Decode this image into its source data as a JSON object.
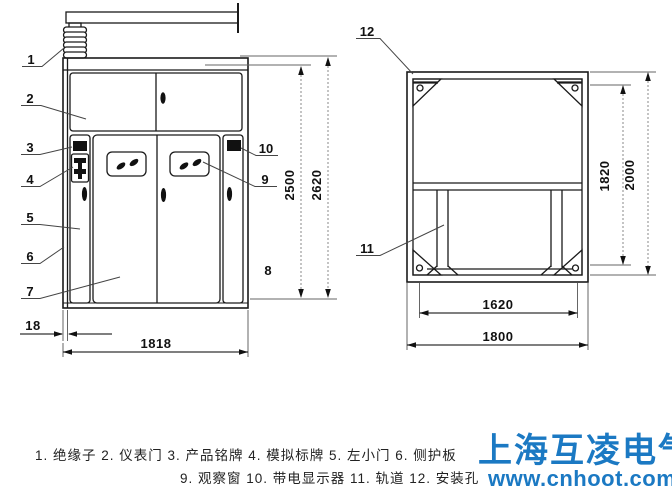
{
  "callouts": {
    "c1": "1",
    "c2": "2",
    "c3": "3",
    "c4": "4",
    "c5": "5",
    "c6": "6",
    "c7": "7",
    "c8": "8",
    "c9": "9",
    "c10": "10",
    "c11": "11",
    "c12": "12"
  },
  "dimensions": {
    "front": {
      "door_height": "2500",
      "total_height": "2620",
      "width": "1818",
      "side_offset": "18"
    },
    "plan": {
      "frame_height": "1820",
      "total_height": "2000",
      "inner_width": "1620",
      "total_width": "1800"
    }
  },
  "legend": {
    "line1": "1. 绝缘子  2. 仪表门  3. 产品铭牌  4. 模拟标牌  5. 左小门  6. 侧护板",
    "line2": "9. 观察窗  10. 带电显示器 11. 轨道  12. 安装孔"
  },
  "watermark": {
    "brand": "上海互凌电气",
    "site": "www.cnhoot.com",
    "color": "#1b79c3"
  },
  "colors": {
    "line": "#1a1a1a",
    "dim_line": "#888888",
    "background": "#ffffff"
  }
}
